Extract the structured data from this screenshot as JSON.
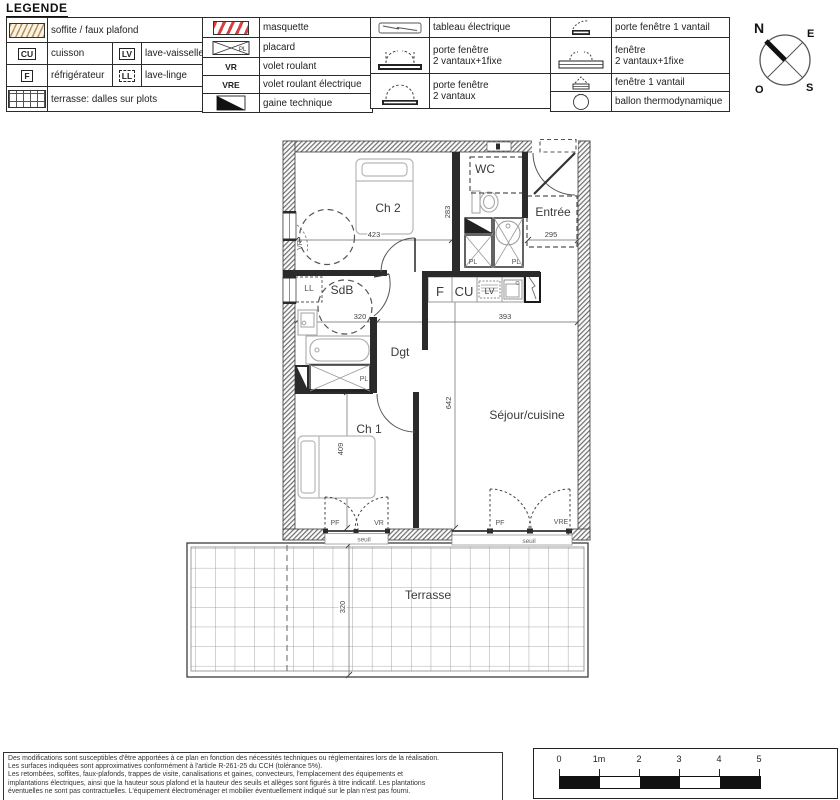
{
  "legend": {
    "title": "LEGENDE",
    "soffite": "soffite / faux plafond",
    "cu_key": "CU",
    "cuisson": "cuisson",
    "lv_key": "LV",
    "lave_vaisselle": "lave-vaisselle",
    "f_key": "F",
    "refrigerateur": "réfrigérateur",
    "ll_key": "LL",
    "lave_linge": "lave-linge",
    "terrasse": "terrasse: dalles sur plots",
    "masquette": "masquette",
    "pl_key": "PL",
    "placard": "placard",
    "vr_key": "VR",
    "volet_roulant": "volet roulant",
    "vre_key": "VRE",
    "volet_roulant_electrique": "volet roulant électrique",
    "gaine": "gaine technique",
    "tableau": "tableau électrique",
    "pf_2v1f_line1": "porte fenêtre",
    "pf_2v1f_line2": "2 vantaux+1fixe",
    "pf_2v_line1": "porte fenêtre",
    "pf_2v_line2": "2 vantaux",
    "pf_1v": "porte fenêtre 1 vantail",
    "fen_2v1f_line1": "fenêtre",
    "fen_2v1f_line2": "2 vantaux+1fixe",
    "fen_1v": "fenêtre 1 vantail",
    "ballon": "ballon thermodynamique"
  },
  "compass": {
    "n": "N",
    "e": "E",
    "o": "O",
    "s": "S"
  },
  "plan": {
    "rooms": {
      "ch2": "Ch 2",
      "wc": "WC",
      "entree": "Entrée",
      "sdb": "SdB",
      "dgt": "Dgt",
      "ch1": "Ch 1",
      "sejour": "Séjour/cuisine",
      "terrasse": "Terrasse"
    },
    "dims": {
      "ch2_width": "423",
      "ch2_height": "283",
      "entree_width": "295",
      "sdb_width": "320",
      "sejour_width": "393",
      "sejour_height": "642",
      "ch1_height": "409",
      "terrasse_depth": "320"
    },
    "tags": {
      "vr": "VR",
      "vre": "VRE",
      "pf": "PF",
      "pl": "PL",
      "ll": "LL",
      "f": "F",
      "cu": "CU",
      "lv": "LV",
      "seuil": "seuil"
    }
  },
  "footer": {
    "lines": [
      "Des modifications sont susceptibles d'être apportées à ce plan en fonction des nécessités techniques ou réglementaires lors de la réalisation.",
      "Les surfaces indiquées sont approximatives conformément à l'article R-261-25 du CCH (tolérance 5%).",
      "Les retombées, soffites, faux-plafonds, trappes de visite, canalisations et gaines, convecteurs, l'emplacement des équipements et",
      "implantations électriques, ainsi que la hauteur sous plafond et la hauteur des seuils et allèges sont figurés à titre indicatif. Les plantations",
      "éventuelles ne sont pas contractuelles. L'équipement électroménager et mobilier éventuellement indiqué sur le plan n'est pas fourni."
    ]
  },
  "scalebar": {
    "labels": [
      "0",
      "1m",
      "2",
      "3",
      "4",
      "5"
    ]
  },
  "colors": {
    "soffite_hatch": "#b8905a",
    "masquette_stripe": "#d84040",
    "wall_line": "#2b2b2b",
    "furniture_line": "#b8b8b8"
  }
}
